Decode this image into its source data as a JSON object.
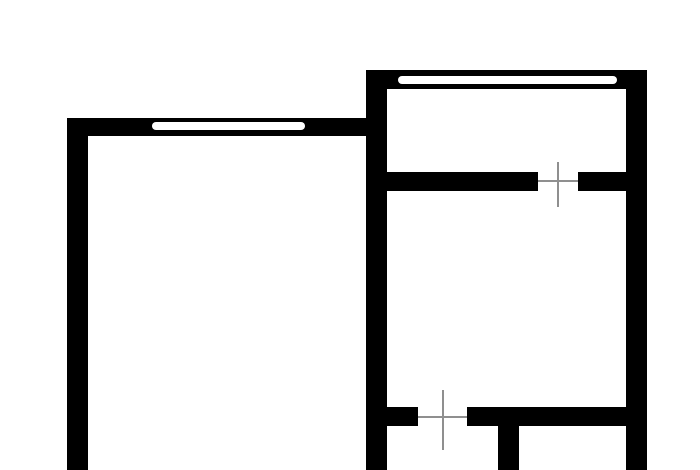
{
  "colors": {
    "background": "#ffffff",
    "wall": "#000000",
    "window": "#ffffff",
    "door_marker": "#8f8f8f"
  },
  "floor_plan": {
    "canvas": {
      "width": 700,
      "height": 470
    },
    "walls": [
      {
        "name": "left-exterior-wall",
        "x": 67,
        "y": 118,
        "w": 21,
        "h": 352
      },
      {
        "name": "left-room-top-wall",
        "x": 67,
        "y": 118,
        "w": 299,
        "h": 18
      },
      {
        "name": "center-shared-wall",
        "x": 366,
        "y": 70,
        "w": 21,
        "h": 400
      },
      {
        "name": "right-room-top-wall",
        "x": 366,
        "y": 70,
        "w": 281,
        "h": 19
      },
      {
        "name": "right-exterior-wall",
        "x": 626,
        "y": 70,
        "w": 21,
        "h": 400
      },
      {
        "name": "upper-divider-wall-left-segment",
        "x": 387,
        "y": 172,
        "w": 151,
        "h": 19
      },
      {
        "name": "upper-divider-wall-right-segment",
        "x": 578,
        "y": 172,
        "w": 48,
        "h": 19
      },
      {
        "name": "lower-divider-wall-left-stub",
        "x": 387,
        "y": 407,
        "w": 31,
        "h": 19
      },
      {
        "name": "lower-divider-wall-right-segment",
        "x": 467,
        "y": 407,
        "w": 159,
        "h": 19
      },
      {
        "name": "bottom-partition-wall",
        "x": 498,
        "y": 426,
        "w": 21,
        "h": 44
      }
    ],
    "windows": [
      {
        "name": "left-room-window",
        "x": 152,
        "y": 122,
        "w": 153,
        "h": 8
      },
      {
        "name": "right-room-window",
        "x": 398,
        "y": 76,
        "w": 219,
        "h": 8
      }
    ],
    "door_markers": [
      {
        "name": "upper-door-marker",
        "v_line": {
          "x": 557,
          "y": 162,
          "w": 2,
          "h": 45
        },
        "h_line": {
          "x": 538,
          "y": 180,
          "w": 40,
          "h": 2
        }
      },
      {
        "name": "lower-door-marker",
        "v_line": {
          "x": 442,
          "y": 390,
          "w": 2,
          "h": 60
        },
        "h_line": {
          "x": 418,
          "y": 416,
          "w": 49,
          "h": 2
        }
      }
    ]
  }
}
